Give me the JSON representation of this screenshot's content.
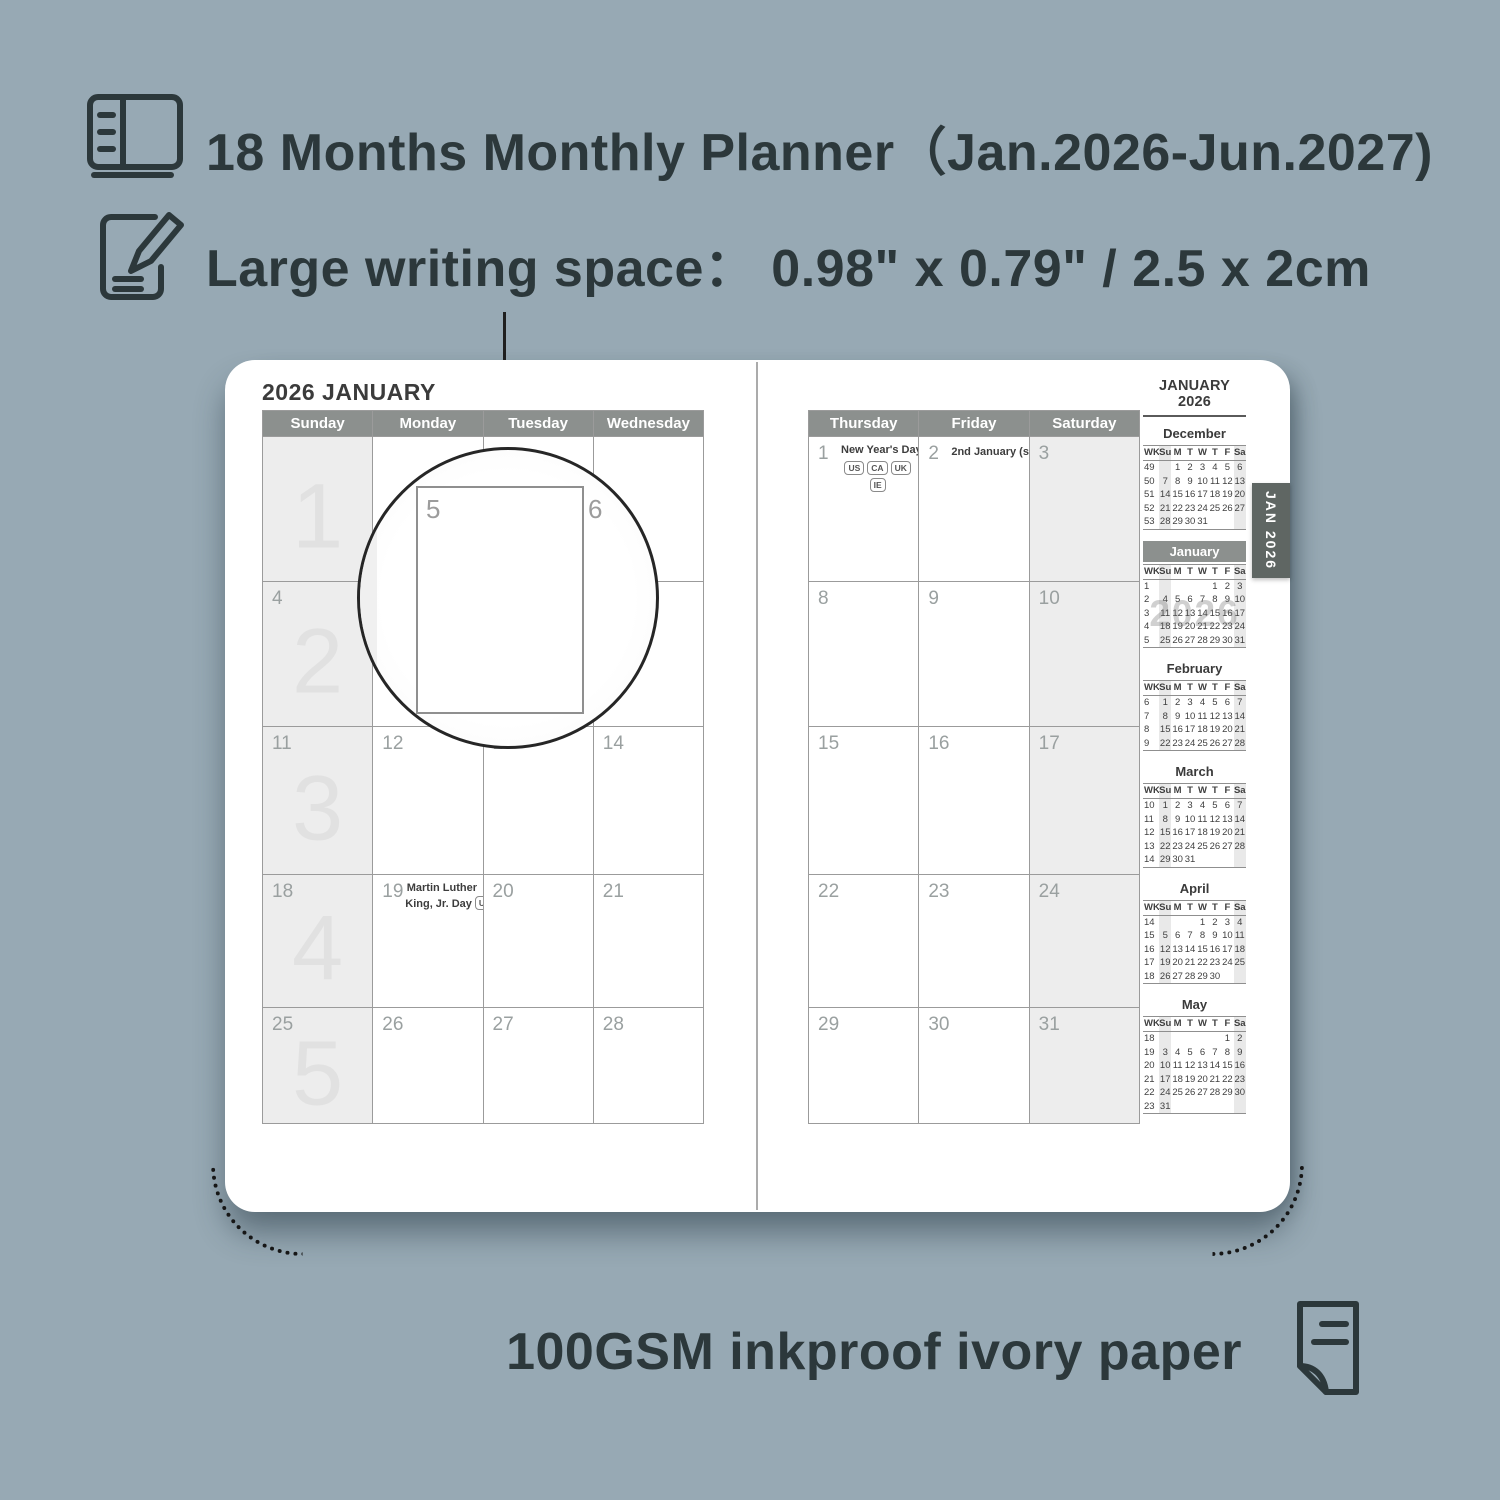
{
  "background_color": "#97a9b4",
  "accent_colors": {
    "dark_text": "#2c383b",
    "header_gray": "#8c908e",
    "tab_gray": "#5f6663",
    "weekend_fill": "#ededed"
  },
  "features": {
    "months_range": "18 Months Monthly Planner（Jan.2026-Jun.2027)",
    "writing_space": "Large writing space：  0.98\" x 0.79\" / 2.5 x 2cm",
    "paper": "100GSM inkproof ivory paper"
  },
  "magnifier": {
    "cell_labels": [
      "5",
      "6"
    ]
  },
  "planner": {
    "tab_label": "JAN 2026",
    "left_page": {
      "title": "2026 JANUARY",
      "day_headers": [
        "Sunday",
        "Monday",
        "Tuesday",
        "Wednesday"
      ],
      "weeks": [
        {
          "cells": [
            {
              "date": "",
              "shaded": true,
              "big": "1"
            },
            {
              "date": ""
            },
            {
              "date": ""
            },
            {
              "date": ""
            }
          ]
        },
        {
          "cells": [
            {
              "date": "4",
              "shaded": true,
              "big": "2"
            },
            {
              "date": "5"
            },
            {
              "date": "6"
            },
            {
              "date": "7"
            }
          ]
        },
        {
          "cells": [
            {
              "date": "11",
              "shaded": true,
              "big": "3"
            },
            {
              "date": "12"
            },
            {
              "date": "13"
            },
            {
              "date": "14"
            }
          ]
        },
        {
          "cells": [
            {
              "date": "18",
              "shaded": true,
              "big": "4"
            },
            {
              "date": "19",
              "holiday_lines": [
                "Martin Luther",
                "King, Jr. Day"
              ],
              "badges": [
                "US"
              ],
              "badges_inline": true
            },
            {
              "date": "20"
            },
            {
              "date": "21"
            }
          ]
        },
        {
          "cells": [
            {
              "date": "25",
              "shaded": true,
              "big": "5"
            },
            {
              "date": "26"
            },
            {
              "date": "27"
            },
            {
              "date": "28"
            }
          ]
        }
      ]
    },
    "right_page": {
      "day_headers": [
        "Thursday",
        "Friday",
        "Saturday"
      ],
      "weeks": [
        {
          "cells": [
            {
              "date": "1",
              "holiday_lines": [
                "New Year's Day"
              ],
              "badges": [
                "US",
                "CA",
                "UK",
                "IE"
              ]
            },
            {
              "date": "2",
              "holiday_lines": [
                "2nd January (sc.)"
              ],
              "badges": [
                "UK"
              ],
              "badges_inline": true
            },
            {
              "date": "3",
              "shaded": true
            }
          ]
        },
        {
          "cells": [
            {
              "date": "8"
            },
            {
              "date": "9"
            },
            {
              "date": "10",
              "shaded": true
            }
          ]
        },
        {
          "cells": [
            {
              "date": "15"
            },
            {
              "date": "16"
            },
            {
              "date": "17",
              "shaded": true
            }
          ]
        },
        {
          "cells": [
            {
              "date": "22"
            },
            {
              "date": "23"
            },
            {
              "date": "24",
              "shaded": true
            }
          ]
        },
        {
          "cells": [
            {
              "date": "29"
            },
            {
              "date": "30"
            },
            {
              "date": "31",
              "shaded": true
            }
          ]
        }
      ]
    },
    "mini_column": {
      "title": "JANUARY 2026",
      "dow_header": [
        "WK",
        "Su",
        "M",
        "T",
        "W",
        "T",
        "F",
        "Sa"
      ],
      "months": [
        {
          "name": "December",
          "selected": false,
          "weeks": [
            [
              "49",
              "",
              "1",
              "2",
              "3",
              "4",
              "5",
              "6"
            ],
            [
              "50",
              "7",
              "8",
              "9",
              "10",
              "11",
              "12",
              "13"
            ],
            [
              "51",
              "14",
              "15",
              "16",
              "17",
              "18",
              "19",
              "20"
            ],
            [
              "52",
              "21",
              "22",
              "23",
              "24",
              "25",
              "26",
              "27"
            ],
            [
              "53",
              "28",
              "29",
              "30",
              "31",
              "",
              "",
              ""
            ]
          ]
        },
        {
          "name": "January",
          "selected": true,
          "watermark": "2026",
          "weeks": [
            [
              "1",
              "",
              "",
              "",
              "",
              "1",
              "2",
              "3"
            ],
            [
              "2",
              "4",
              "5",
              "6",
              "7",
              "8",
              "9",
              "10"
            ],
            [
              "3",
              "11",
              "12",
              "13",
              "14",
              "15",
              "16",
              "17"
            ],
            [
              "4",
              "18",
              "19",
              "20",
              "21",
              "22",
              "23",
              "24"
            ],
            [
              "5",
              "25",
              "26",
              "27",
              "28",
              "29",
              "30",
              "31"
            ]
          ]
        },
        {
          "name": "February",
          "selected": false,
          "weeks": [
            [
              "6",
              "1",
              "2",
              "3",
              "4",
              "5",
              "6",
              "7"
            ],
            [
              "7",
              "8",
              "9",
              "10",
              "11",
              "12",
              "13",
              "14"
            ],
            [
              "8",
              "15",
              "16",
              "17",
              "18",
              "19",
              "20",
              "21"
            ],
            [
              "9",
              "22",
              "23",
              "24",
              "25",
              "26",
              "27",
              "28"
            ]
          ]
        },
        {
          "name": "March",
          "selected": false,
          "weeks": [
            [
              "10",
              "1",
              "2",
              "3",
              "4",
              "5",
              "6",
              "7"
            ],
            [
              "11",
              "8",
              "9",
              "10",
              "11",
              "12",
              "13",
              "14"
            ],
            [
              "12",
              "15",
              "16",
              "17",
              "18",
              "19",
              "20",
              "21"
            ],
            [
              "13",
              "22",
              "23",
              "24",
              "25",
              "26",
              "27",
              "28"
            ],
            [
              "14",
              "29",
              "30",
              "31",
              "",
              "",
              "",
              ""
            ]
          ]
        },
        {
          "name": "April",
          "selected": false,
          "weeks": [
            [
              "14",
              "",
              "",
              "",
              "1",
              "2",
              "3",
              "4"
            ],
            [
              "15",
              "5",
              "6",
              "7",
              "8",
              "9",
              "10",
              "11"
            ],
            [
              "16",
              "12",
              "13",
              "14",
              "15",
              "16",
              "17",
              "18"
            ],
            [
              "17",
              "19",
              "20",
              "21",
              "22",
              "23",
              "24",
              "25"
            ],
            [
              "18",
              "26",
              "27",
              "28",
              "29",
              "30",
              "",
              ""
            ]
          ]
        },
        {
          "name": "May",
          "selected": false,
          "weeks": [
            [
              "18",
              "",
              "",
              "",
              "",
              "",
              "1",
              "2"
            ],
            [
              "19",
              "3",
              "4",
              "5",
              "6",
              "7",
              "8",
              "9"
            ],
            [
              "20",
              "10",
              "11",
              "12",
              "13",
              "14",
              "15",
              "16"
            ],
            [
              "21",
              "17",
              "18",
              "19",
              "20",
              "21",
              "22",
              "23"
            ],
            [
              "22",
              "24",
              "25",
              "26",
              "27",
              "28",
              "29",
              "30"
            ],
            [
              "23",
              "31",
              "",
              "",
              "",
              "",
              "",
              ""
            ]
          ]
        }
      ]
    }
  }
}
